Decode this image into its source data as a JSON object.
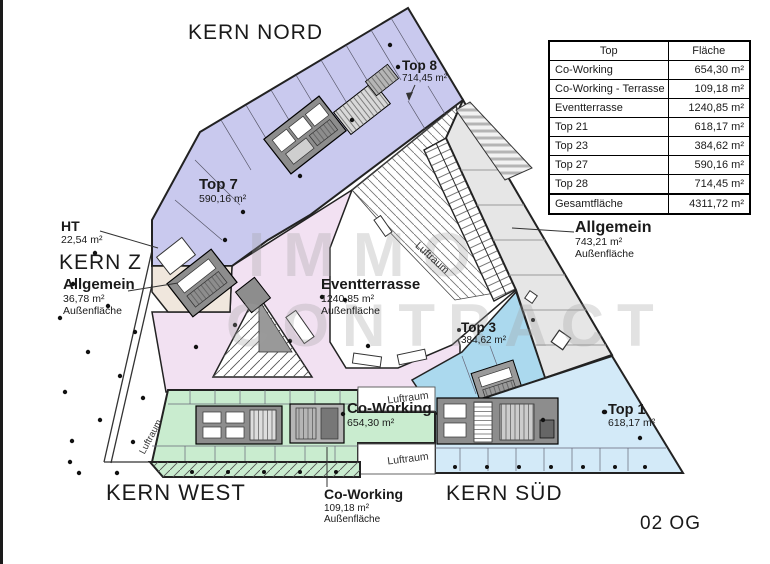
{
  "plan": {
    "kern_nord": "KERN NORD",
    "kern_z": "KERN Z",
    "kern_west": "KERN WEST",
    "kern_sued": "KERN SÜD",
    "floor_label": "02 OG",
    "luftraum": "Luftraum",
    "rooms": {
      "top8": {
        "name": "Top 8",
        "area": "714,45 m²"
      },
      "top7": {
        "name": "Top 7",
        "area": "590,16 m²"
      },
      "ht": {
        "name": "HT",
        "area": "22,54 m²"
      },
      "allgemein_west": {
        "name": "Allgemein",
        "area": "36,78 m²",
        "note": "Außenfläche"
      },
      "eventterrasse": {
        "name": "Eventterrasse",
        "area": "1240,85 m²",
        "note": "Außenfläche"
      },
      "allgemein_ost": {
        "name": "Allgemein",
        "area": "743,21 m²",
        "note": "Außenfläche"
      },
      "top3": {
        "name": "Top 3",
        "area": "384,62 m²"
      },
      "coworking": {
        "name": "Co-Working",
        "area": "654,30 m²"
      },
      "top1": {
        "name": "Top 1",
        "area": "618,17 m²"
      },
      "coworking_terrasse": {
        "name": "Co-Working",
        "area": "109,18 m²",
        "note": "Außenfläche"
      }
    }
  },
  "watermark": {
    "line1": "IMMO",
    "line2": "CONTRACT"
  },
  "table": {
    "headers": [
      "Top",
      "Fläche"
    ],
    "rows": [
      {
        "label": "Co-Working",
        "value": "654,30 m²"
      },
      {
        "label": "Co-Working - Terrasse",
        "value": "109,18 m²"
      },
      {
        "label": "Eventterrasse",
        "value": "1240,85 m²"
      },
      {
        "label": "Top 21",
        "value": "618,17 m²"
      },
      {
        "label": "Top 23",
        "value": "384,62 m²"
      },
      {
        "label": "Top 27",
        "value": "590,16 m²"
      },
      {
        "label": "Top 28",
        "value": "714,45 m²"
      }
    ],
    "total": {
      "label": "Gesamtfläche",
      "value": "4311,72 m²"
    }
  },
  "colors": {
    "wing_purple": "#c9c9ee",
    "circulation_pink": "#f2e1f2",
    "coworking_green": "#c9eccf",
    "top3_blue": "#abd9ee",
    "top1_blue": "#d3eaf8",
    "outdoor_gray": "#e6e6e6",
    "core_gray": "#8d8d8d",
    "kernz_beige": "#f0e7dd"
  }
}
